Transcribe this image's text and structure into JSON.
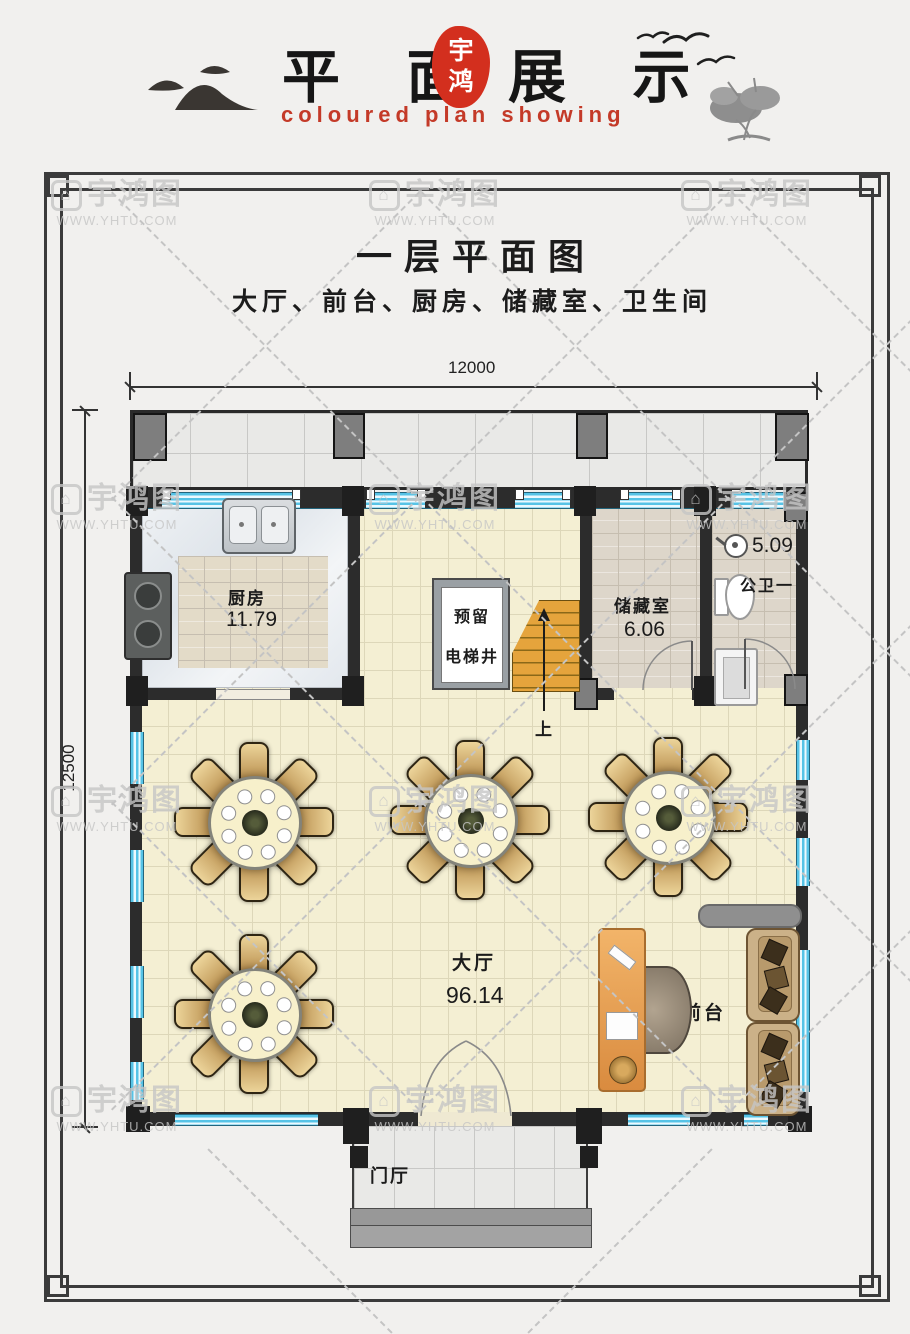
{
  "header": {
    "title_left": "平 面",
    "title_right": "展 示",
    "seal_line1": "宇",
    "seal_line2": "鸿",
    "subtitle": "coloured plan showing"
  },
  "plan": {
    "title": "一层平面图",
    "subtitle": "大厅、前台、厨房、储藏室、卫生间",
    "dim_width": "12000",
    "dim_height": "12500"
  },
  "rooms": {
    "kitchen": {
      "name": "厨房",
      "area": "11.79"
    },
    "elevator": {
      "line1": "预留",
      "line2": "电梯井"
    },
    "stairs_up": "上",
    "storage": {
      "name": "储藏室",
      "area": "6.06"
    },
    "toilet": {
      "name": "公卫一",
      "area": "5.09"
    },
    "hall": {
      "name": "大厅",
      "area": "96.14"
    },
    "front_desk": {
      "name": "前台"
    },
    "foyer": {
      "name": "门厅"
    }
  },
  "watermark": {
    "brand": "宇鸿图",
    "url": "WWW.YHTU.COM"
  },
  "colors": {
    "accent_red": "#d32f1e",
    "wall": "#2c2c2c",
    "window_blue": "#56c3e6",
    "hall_floor": "#f4efd3"
  }
}
